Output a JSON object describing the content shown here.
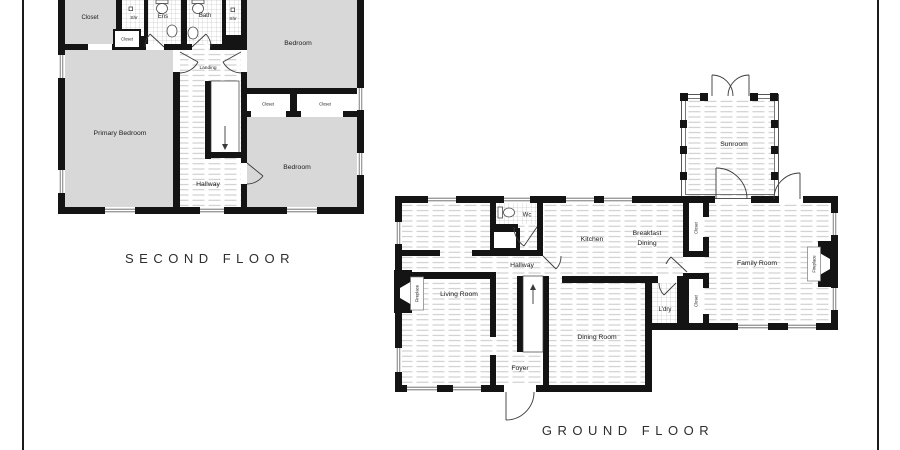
{
  "titles": {
    "second_floor": "SECOND FLOOR",
    "ground_floor": "GROUND FLOOR"
  },
  "second_floor": {
    "rooms": {
      "closet_top_left": "Closet",
      "shower_left": "Shr",
      "ensuite": "Ens",
      "bath": "Bath",
      "shower_right": "Shr",
      "closet_small": "Closet",
      "bedroom_top": "Bedroom",
      "landing": "Landing",
      "closet_left": "Closet",
      "closet_right": "Closet",
      "primary_bedroom": "Primary Bedroom",
      "hallway": "Hallway",
      "bedroom_bottom": "Bedroom"
    }
  },
  "ground_floor": {
    "rooms": {
      "sunroom": "Sunroom",
      "wc": "Wc",
      "kitchen": "Kitchen",
      "breakfast_line1": "Breakfast",
      "breakfast_line2": "Dining",
      "closet_top": "Closet",
      "family_room": "Family Room",
      "fireplace_right": "Fireplace",
      "hallway": "Hallway",
      "living_room": "Living Room",
      "fireplace_left": "Fireplace",
      "laundry": "L'dry",
      "closet_bottom": "Closet",
      "dining_room": "Dining Room",
      "foyer": "Foyer"
    }
  },
  "colors": {
    "wall": "#141414",
    "carpet": "#d8d8d8",
    "plank_line": "#c2c2c2",
    "tile_line": "#a8a8a8",
    "text": "#1c1c1c"
  }
}
